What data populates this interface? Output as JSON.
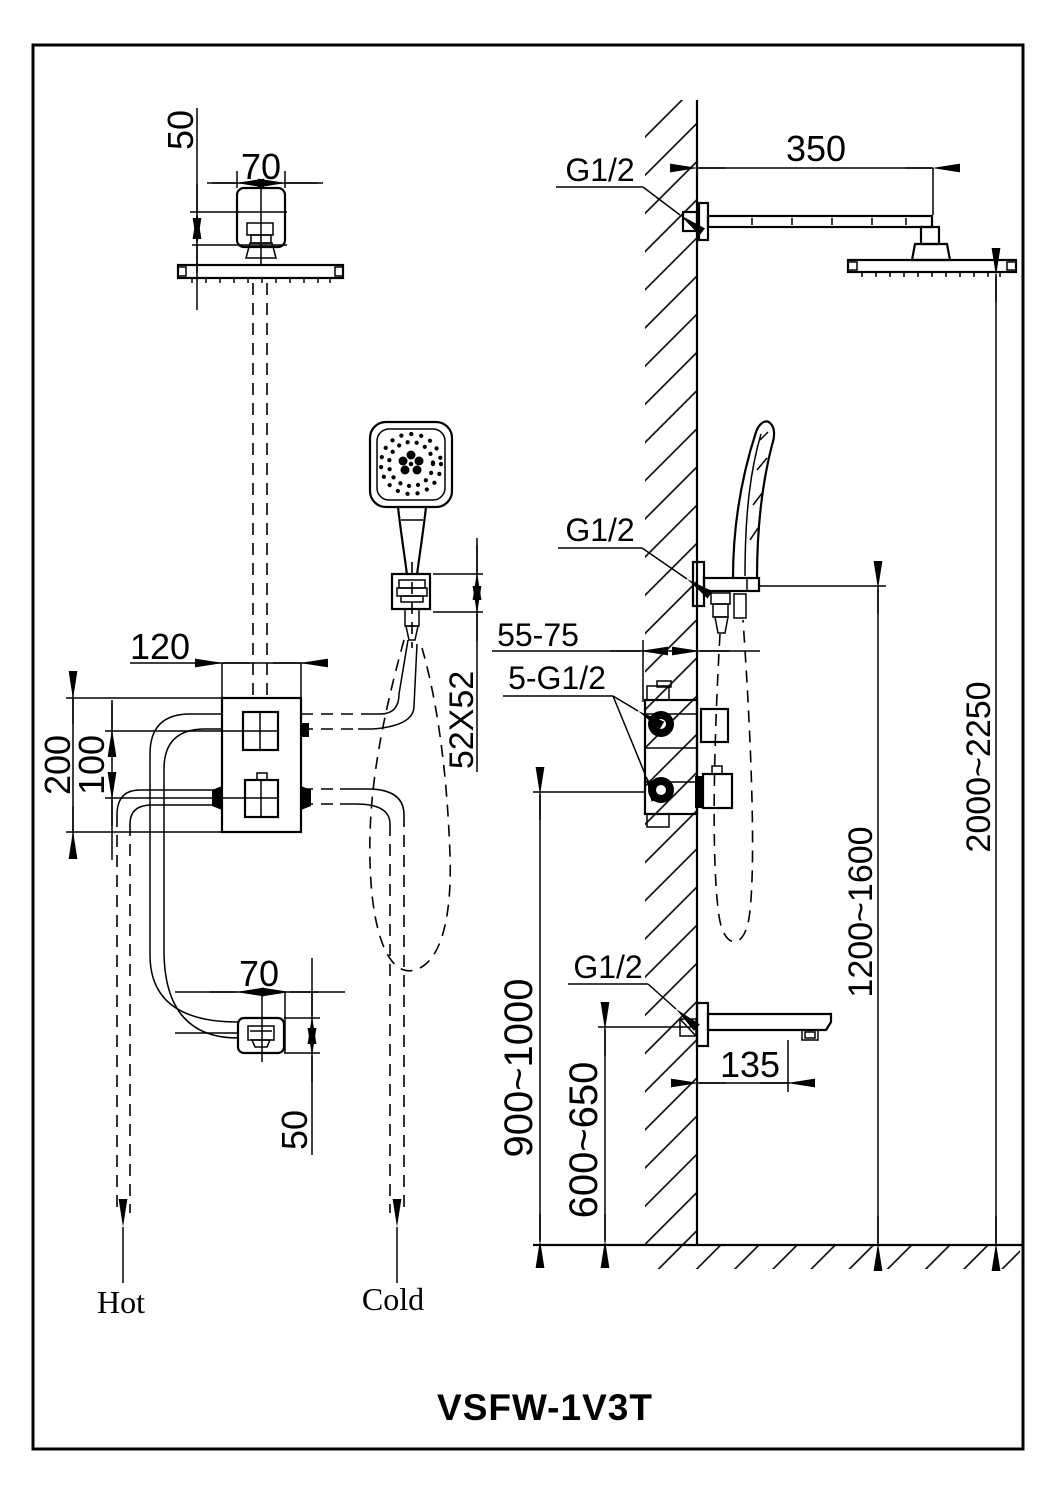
{
  "drawing": {
    "model": "VSFW-1V3T",
    "front": {
      "head_drop": "50",
      "head_mount_width": "70",
      "valve_width": "120",
      "valve_height": "200",
      "knob_spacing": "100",
      "holder_plate": "52X52",
      "spout_width": "70",
      "spout_drop": "50",
      "hot": "Hot",
      "cold": "Cold"
    },
    "side": {
      "arm_thread": "G1/2",
      "arm_length": "350",
      "head_height": "2000~2250",
      "holder_thread": "G1/2",
      "holder_height": "1200~1600",
      "embed_depth": "55-75",
      "ports_thread": "5-G1/2",
      "valve_height": "900~1000",
      "spout_thread": "G1/2",
      "spout_reach": "135",
      "spout_height": "600~650"
    }
  }
}
